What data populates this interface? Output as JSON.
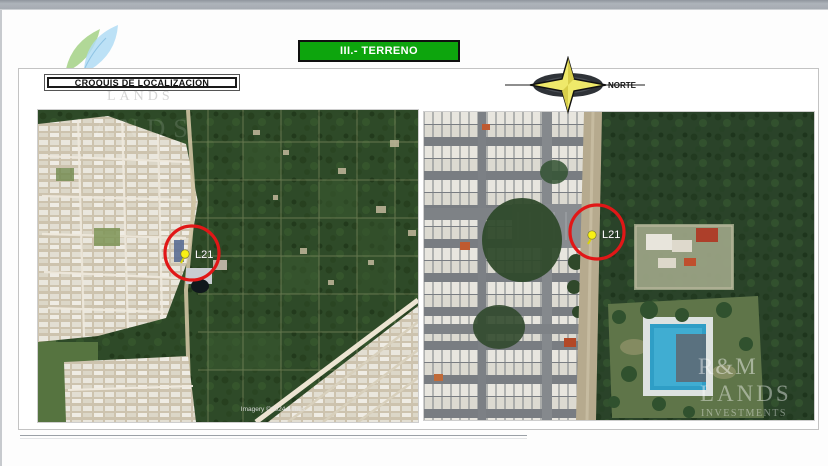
{
  "header": {
    "section_title": "III.- TERRENO",
    "croquis_label": "CROQUIS DE LOCALIZACIÓN",
    "compass_label": "NORTE"
  },
  "maps": {
    "left": {
      "marker_label": "L21",
      "attribution": "Imagery ©2024 Airbus"
    },
    "right": {
      "marker_label": "L21"
    }
  },
  "watermark": {
    "brand": "R&M",
    "brand2": "LANDS",
    "brand3": "INVESTMENTS",
    "ghost": "LANDS",
    "ghost_map": "ANDS"
  },
  "colors": {
    "banner_green": "#0da50d",
    "marker_red": "#e11717",
    "pin_yellow": "#f8f014",
    "pool_blue": "#2f9ec6",
    "titlebar_gray": "#a9aeb5",
    "forest_green": "#2e4a28",
    "urban_tan": "#cdc3ae"
  }
}
